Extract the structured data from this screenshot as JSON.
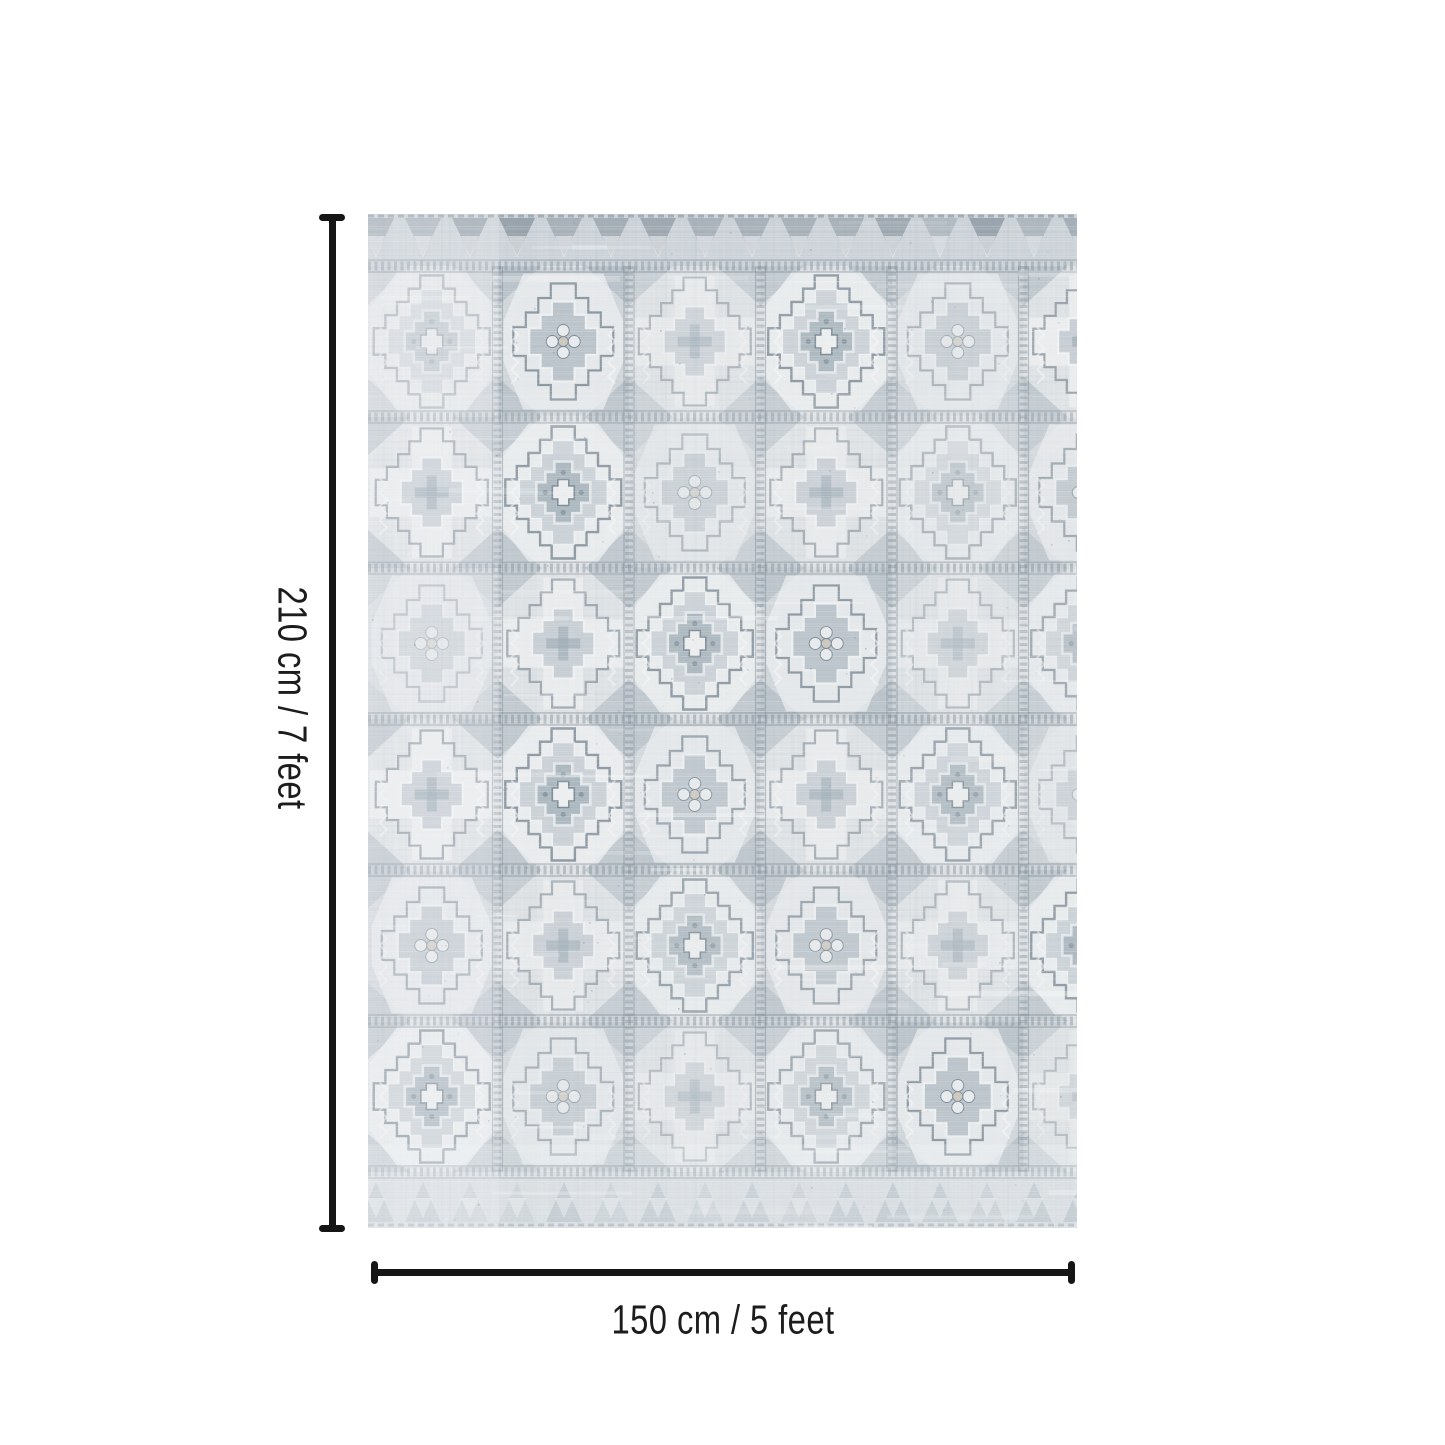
{
  "diagram": {
    "height_label": "210 cm / 7 feet",
    "width_label": "150 cm / 5 feet",
    "height_cm": 210,
    "height_feet": 7,
    "width_cm": 150,
    "width_feet": 5
  },
  "colors": {
    "background": "#ffffff",
    "dimension_line": "#161616",
    "label_text": "#1c1c1c",
    "rug": {
      "base": "#e3e6e8",
      "weave_dark": "#9aa7b0",
      "weave_light": "#f4f6f7",
      "panel_light": "#eef0f1",
      "mid": "#aeb9c1",
      "deep": "#8fa0ab",
      "line": "#76838e",
      "accent_beige": "#cfc7ba",
      "white": "#f7f8f9"
    }
  }
}
